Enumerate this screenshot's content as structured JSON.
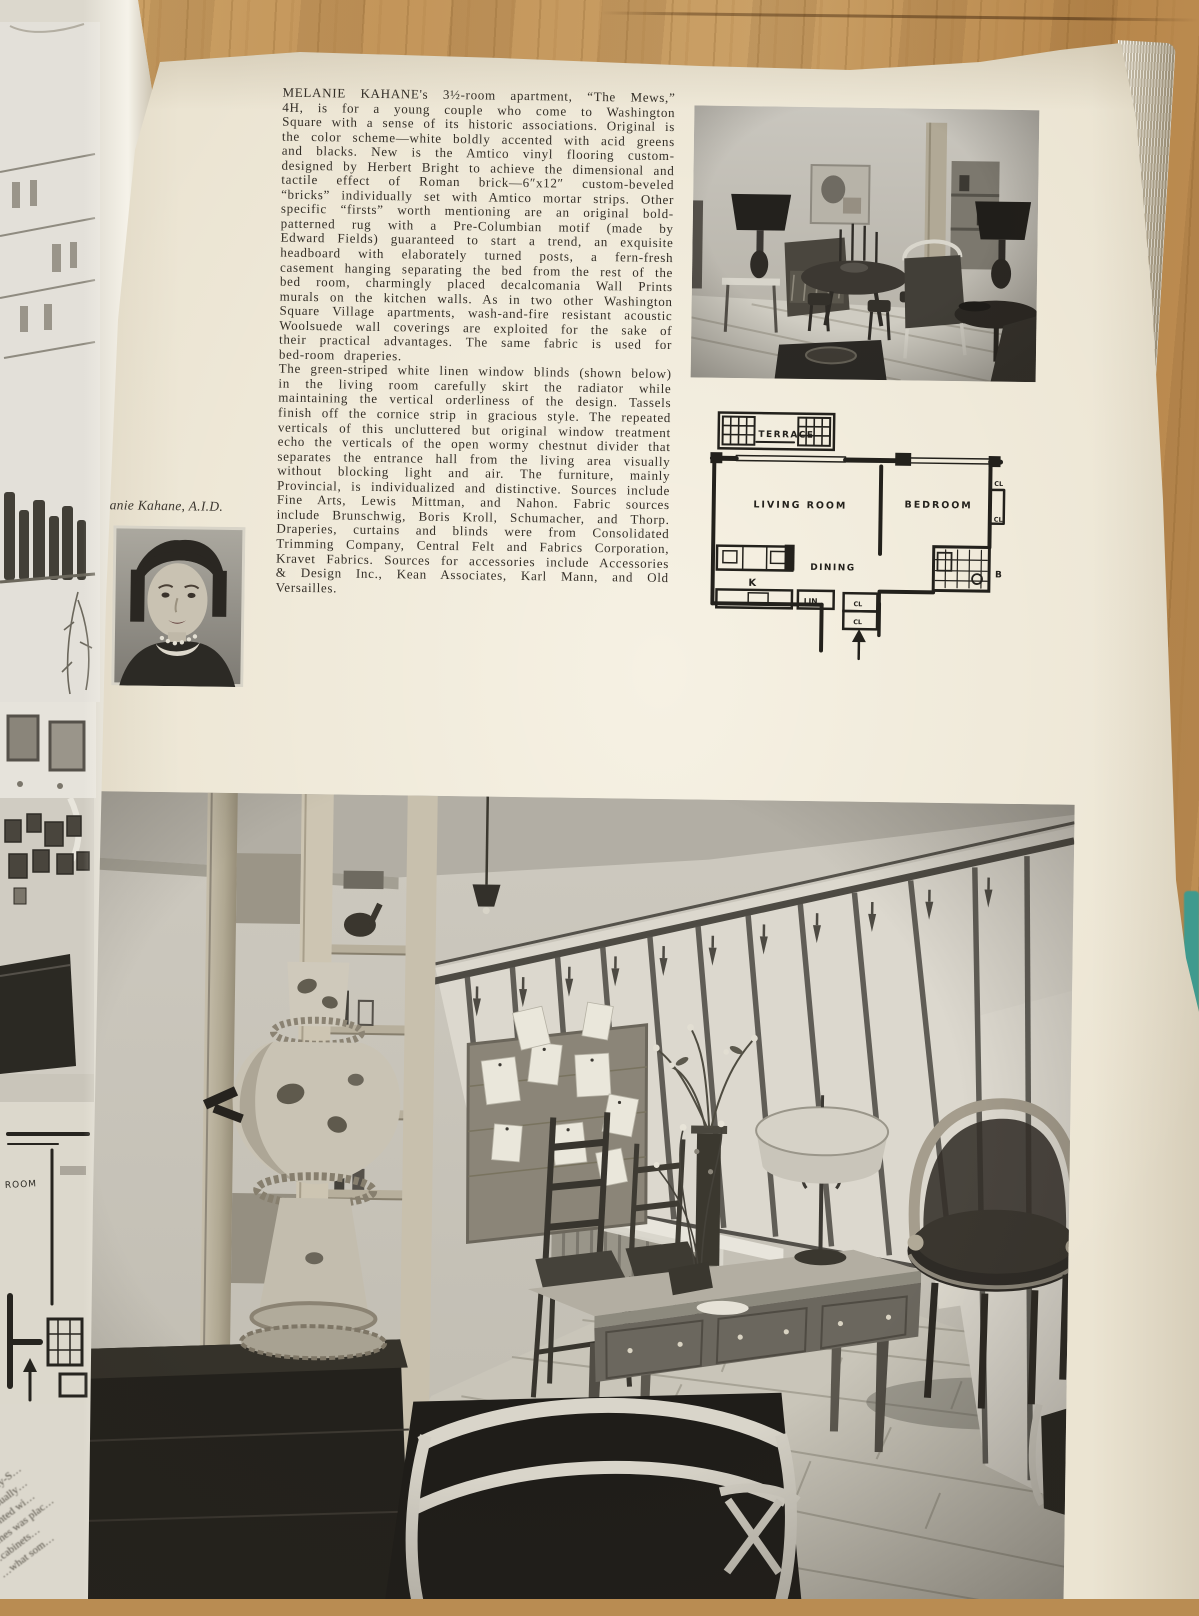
{
  "article": {
    "paragraph1": "MELANIE KAHANE's 3½-room apartment, “The Mews,” 4H, is for a young couple who come to Washington Square with a sense of its historic associations. Original is the color scheme—white boldly accented with acid greens and blacks. New is the Amtico vinyl flooring custom-designed by Herbert Bright to achieve the dimensional and tactile effect of Roman brick—6″x12″ custom-beveled “bricks” individually set with Amtico mortar strips. Other specific “firsts” worth mentioning are an original bold-patterned rug with a Pre-Columbian motif (made by Edward Fields) guaranteed to start a trend, an exquisite headboard with elaborately turned posts, a fern-fresh casement hanging separating the bed from the rest of the bed room, charmingly placed decalcomania Wall Prints murals on the kitchen walls. As in two other Washington Square Village apartments, wash-and-fire resistant acoustic Woolsuede wall coverings are exploited for the sake of their practical advantages. The same fabric is used for bed-room draperies.",
    "paragraph2": "The green-striped white linen window blinds (shown below) in the living room carefully skirt the radiator while maintaining the vertical orderliness of the design. Tassels finish off the cornice strip in gracious style. The repeated verticals of this uncluttered but original window treatment echo the verticals of the open wormy chestnut divider that separates the entrance hall from the living area visually without blocking light and air. The furniture, mainly Provincial, is individualized and distinctive. Sources include Fine Arts, Lewis Mittman, and Nahon. Fabric sources include Brunschwig, Boris Kroll, Schumacher, and Thorp. Draperies, curtains and blinds were from Consolidated Trimming Company, Central Felt and Fabrics Corporation, Kravet Fabrics. Sources for accessories include Accessories & Design Inc., Kean Associates, Karl Mann, and Old Versailles."
  },
  "portrait": {
    "caption": "Melanie Kahane, A.I.D."
  },
  "floorplan": {
    "labels": {
      "terrace": "TERRACE",
      "living_room": "LIVING ROOM",
      "bedroom": "BEDROOM",
      "dining": "DINING",
      "kitchen": "K",
      "linen": "LIN",
      "bath": "B",
      "closet": "CL"
    }
  },
  "left_page": {
    "plan_fragment_label": "ROOM",
    "text_fragments": [
      "…sky's “City-S…",
      "…tive visually…",
      "…accented wi…",
      "…times was plac…",
      "…cabinets…",
      "…what som…"
    ]
  },
  "photos": {
    "top_photo_alt": "Living room with dining group, candlesticks, lamps and armchairs on brick-pattern floor",
    "bottom_photo_alt": "Living room with green-striped white linen window blinds, tassels, desk, chairs and wormy chestnut divider",
    "portrait_alt": "Black and white portrait of Melanie Kahane"
  },
  "colors": {
    "wood_table": "#c3955a",
    "page_paper": "#ebe4d2",
    "teal_edge": "#3f9a8e"
  }
}
